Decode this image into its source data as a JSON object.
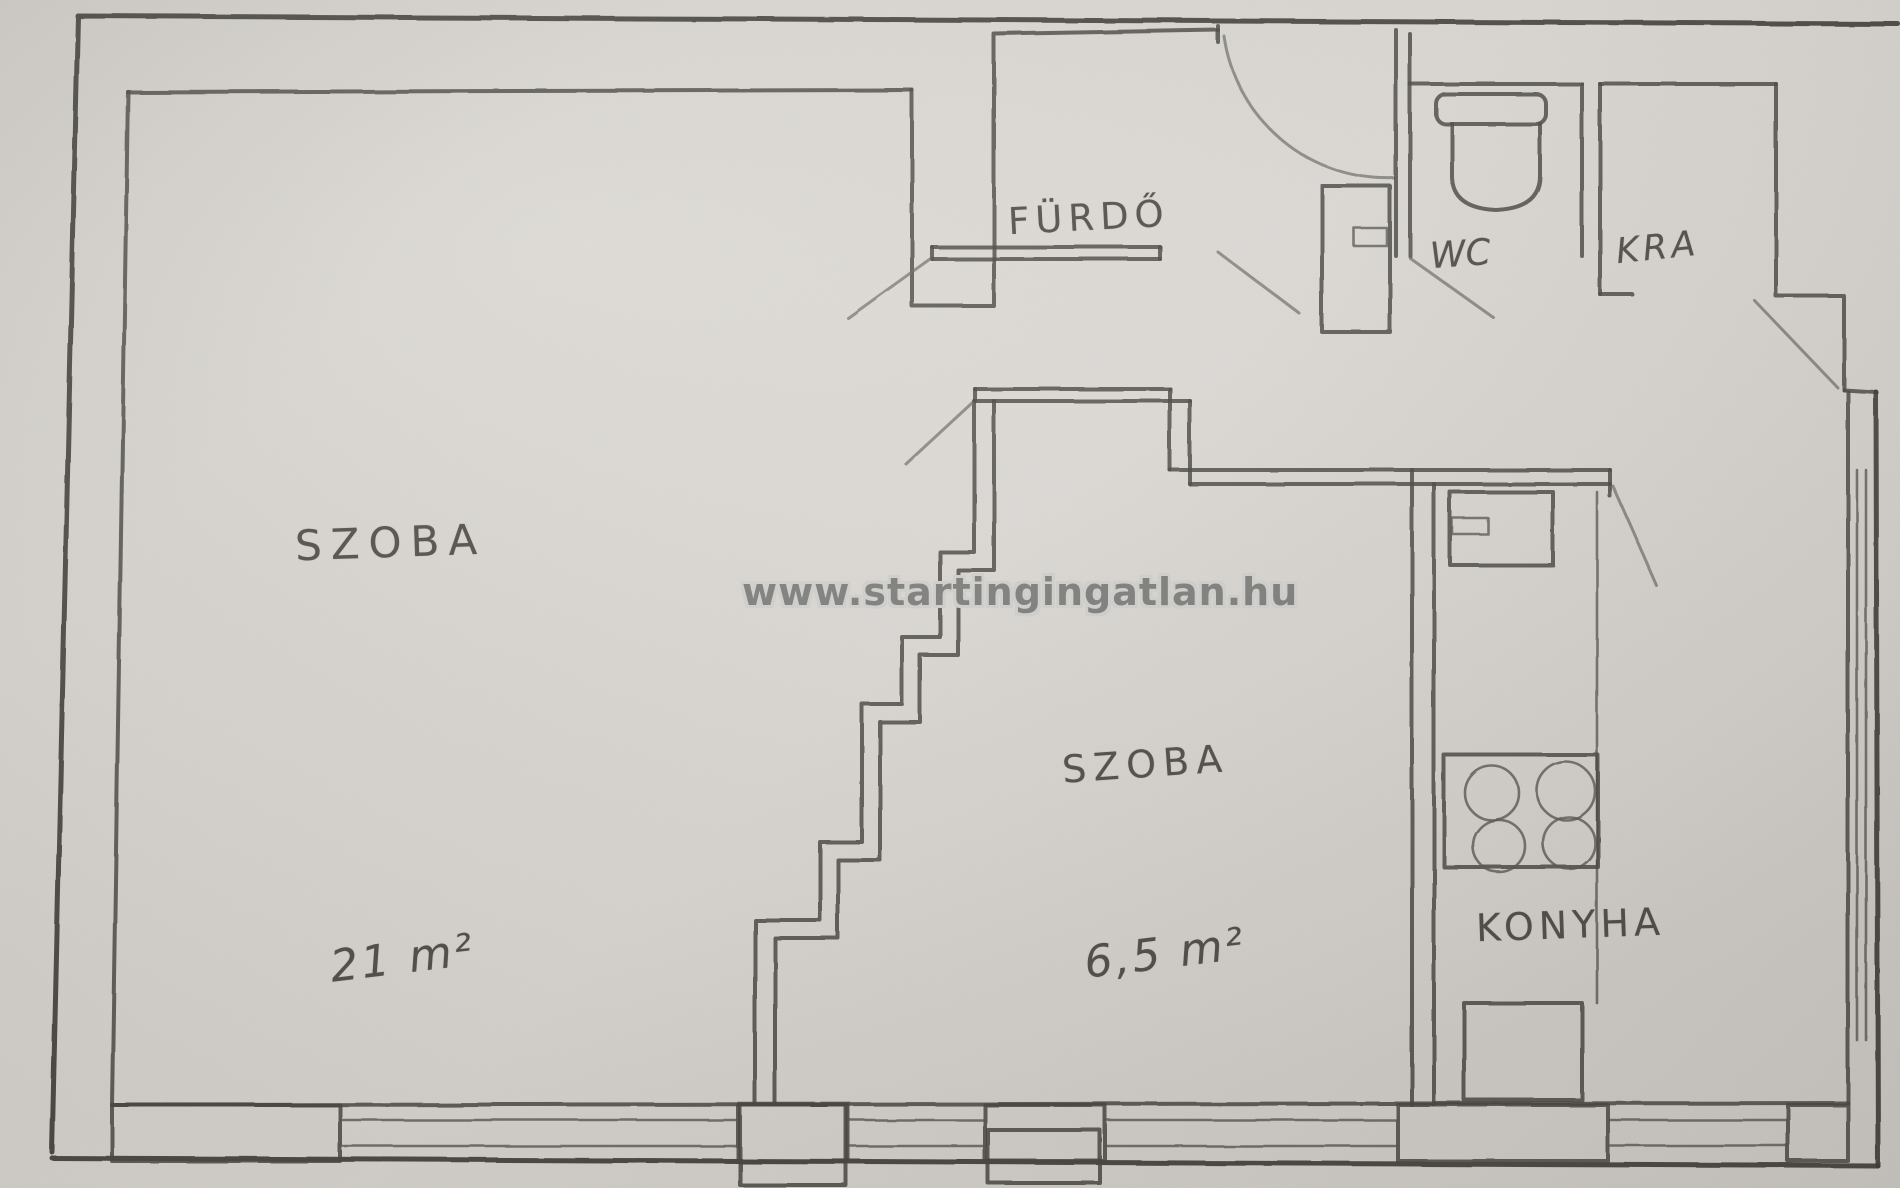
{
  "watermark": {
    "text": "www.startingingatlan.hu"
  },
  "rooms": {
    "szoba_large": {
      "label": "SZOBA",
      "area": "21 m²"
    },
    "szoba_small": {
      "label": "SZOBA",
      "area": "6,5 m²"
    },
    "furdo": {
      "label": "FÜRDŐ"
    },
    "wc": {
      "label": "WC"
    },
    "kamra": {
      "label": "KRA"
    },
    "konyha": {
      "label": "KONYHA"
    }
  }
}
